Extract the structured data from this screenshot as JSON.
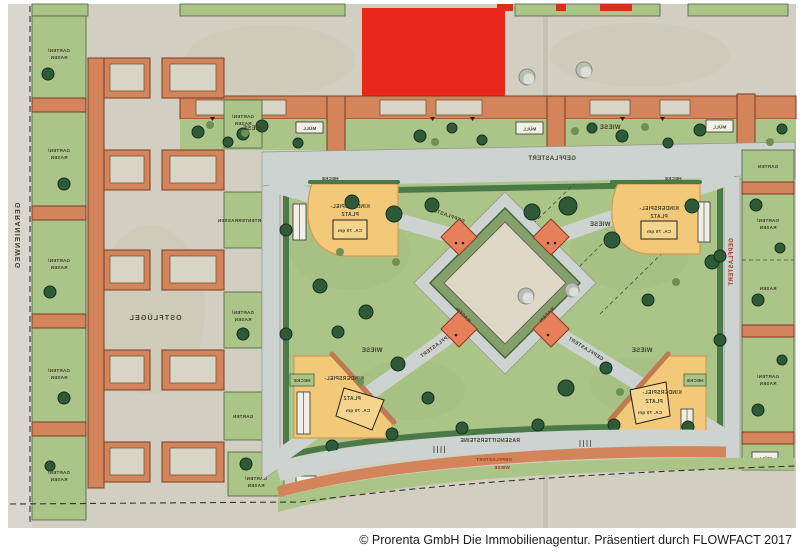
{
  "caption": "© Prorenta GmbH Die Immobilienagentur. Präsentiert durch FLOWFACT 2017",
  "plan": {
    "street_name": "GERANIENWEG",
    "courtyard_label": "OSTFLÜGEL",
    "labels": {
      "wiese": "WIESE",
      "garten": "GARTEN",
      "rasen": "RASEN",
      "garten_slash": "GARTEN/",
      "hecke": "HECKE",
      "muell": "MÜLL",
      "gepflastert": "GEPFLASTERT",
      "rasengittersteine": "RASENGITTERSTEINE",
      "gartenterrassen": "GARTENTERRASSEN",
      "kinderspiel1": "KINDERSPIEL-",
      "kinderspiel2": "PLATZ",
      "kinderspiel3": "CA. 70 qm"
    },
    "colors": {
      "lawn": "#abc487",
      "hedge": "#4b7a49",
      "building": "#d4845a",
      "highlight_red": "#e82a16",
      "path_grey": "#cdd3d0",
      "play_yellow": "#f2c979",
      "bed_orange": "#e5805a",
      "paper": "#d2cec1"
    }
  }
}
